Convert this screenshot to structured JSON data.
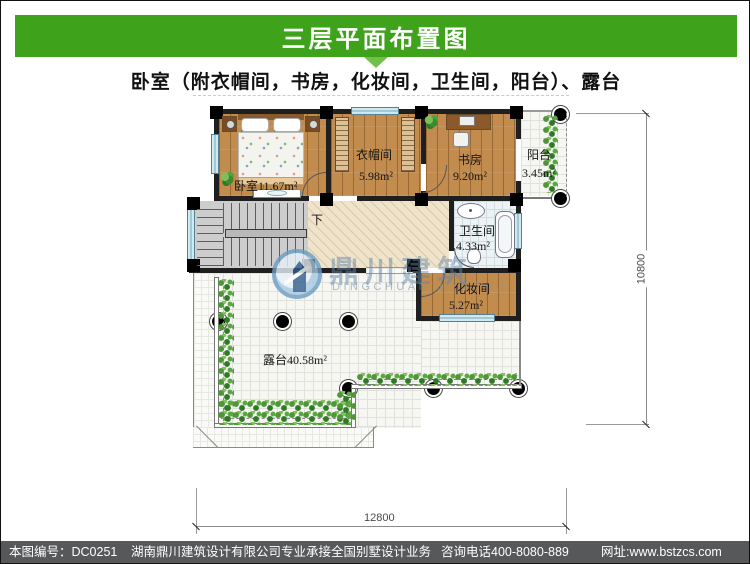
{
  "header": {
    "title": "三层平面布置图",
    "subtitle": "卧室（附衣帽间，书房，化妆间，卫生间，阳台）、露台",
    "bar_color": "#3EA21B",
    "arrow_color": "#72BF4A"
  },
  "plan": {
    "bedroom": {
      "label": "卧室11.67m²"
    },
    "cloakroom": {
      "name": "衣帽间",
      "area": "5.98m²"
    },
    "study": {
      "name": "书房",
      "area": "9.20m²"
    },
    "balcony": {
      "name": "阳台",
      "area": "3.45m²"
    },
    "bathroom": {
      "name": "卫生间",
      "area": "4.33m²"
    },
    "dressing": {
      "name": "化妆间",
      "area": "5.27m²"
    },
    "terrace": {
      "label": "露台40.58m²"
    },
    "stairs": {
      "down_label": "下"
    },
    "dimensions": {
      "width_mm": "12800",
      "height_mm": "10800"
    },
    "watermark": {
      "cn": "鼎川建筑",
      "en": "DINGCHUAN JIANZHU"
    }
  },
  "footer": {
    "code": "本图编号：DC0251",
    "company": "湖南鼎川建筑设计有限公司专业承接全国别墅设计业务",
    "phone": "咨询电话400-8080-889",
    "site": "网址:www.bstzcs.com",
    "bar_color": "#57585A"
  }
}
